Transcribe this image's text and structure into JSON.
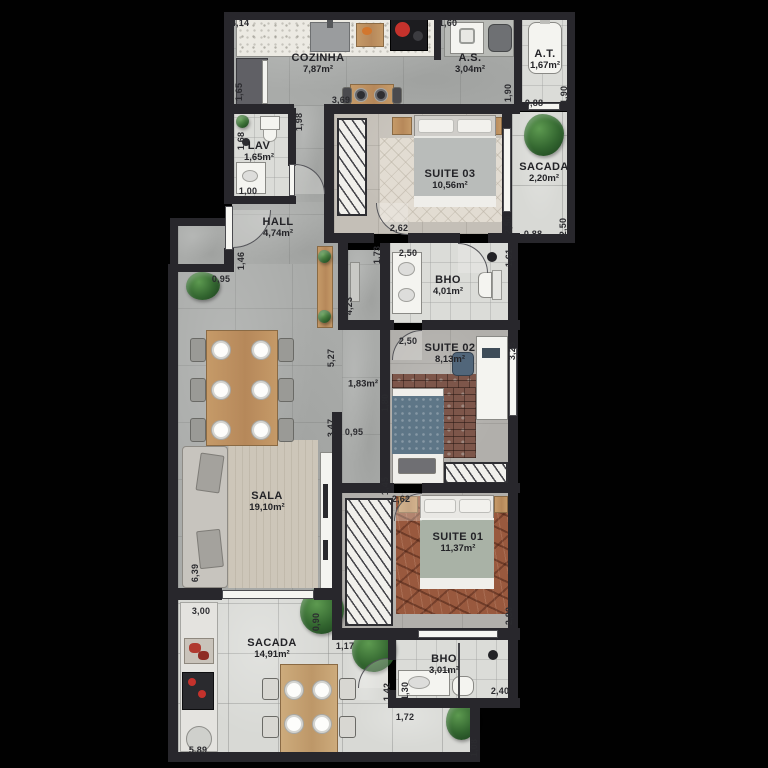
{
  "plan_title": "apartment-floor-plan",
  "colors": {
    "background": "#000000",
    "wall": "#28272c",
    "floor_concrete": "#a9aba9",
    "floor_balcony": "#d8d9d5",
    "wood": "#c59a68",
    "bed_blue": "#5e7687",
    "rug_terracotta": "#99593e",
    "plant_green": "#32652f",
    "label_text": "#232327"
  },
  "rooms": [
    {
      "id": "cozinha",
      "name": "COZINHA",
      "area": "7,87m²",
      "x": 318,
      "y": 64
    },
    {
      "id": "as",
      "name": "A.S.",
      "area": "3,04m²",
      "x": 470,
      "y": 64
    },
    {
      "id": "at",
      "name": "A.T.",
      "area": "1,67m²",
      "x": 545,
      "y": 60
    },
    {
      "id": "lav",
      "name": "LAV",
      "area": "1,65m²",
      "x": 259,
      "y": 152
    },
    {
      "id": "hall",
      "name": "HALL",
      "area": "4,74m²",
      "x": 278,
      "y": 228
    },
    {
      "id": "suite03",
      "name": "SUITE 03",
      "area": "10,56m²",
      "x": 450,
      "y": 180
    },
    {
      "id": "sacada-superior",
      "name": "SACADA",
      "area": "2,20m²",
      "x": 544,
      "y": 173
    },
    {
      "id": "bho-suites",
      "name": "BHO",
      "area": "4,01m²",
      "x": 448,
      "y": 286
    },
    {
      "id": "suite02",
      "name": "SUITE 02",
      "area": "8,13m²",
      "x": 450,
      "y": 354
    },
    {
      "id": "corredor",
      "name": "",
      "area": "1,83m²",
      "x": 363,
      "y": 385
    },
    {
      "id": "sala",
      "name": "SALA",
      "area": "19,10m²",
      "x": 267,
      "y": 502
    },
    {
      "id": "suite01",
      "name": "SUITE 01",
      "area": "11,37m²",
      "x": 458,
      "y": 543
    },
    {
      "id": "sacada-inferior",
      "name": "SACADA",
      "area": "14,91m²",
      "x": 272,
      "y": 649
    },
    {
      "id": "bho-sacada",
      "name": "BHO",
      "area": "3,01m²",
      "x": 444,
      "y": 665
    }
  ],
  "dimensions": [
    {
      "t": "4,14",
      "x": 240,
      "y": 23,
      "v": false
    },
    {
      "t": "1,60",
      "x": 448,
      "y": 23,
      "v": false
    },
    {
      "t": "1,65",
      "x": 239,
      "y": 92,
      "v": true
    },
    {
      "t": "3,69",
      "x": 341,
      "y": 100,
      "v": false
    },
    {
      "t": "1,98",
      "x": 299,
      "y": 122,
      "v": true
    },
    {
      "t": "1,90",
      "x": 508,
      "y": 93,
      "v": true
    },
    {
      "t": "0,88",
      "x": 534,
      "y": 103,
      "v": false
    },
    {
      "t": "1,90",
      "x": 564,
      "y": 95,
      "v": true
    },
    {
      "t": "1,68",
      "x": 241,
      "y": 141,
      "v": true
    },
    {
      "t": "1,00",
      "x": 248,
      "y": 191,
      "v": false
    },
    {
      "t": "2,50",
      "x": 508,
      "y": 225,
      "v": true
    },
    {
      "t": "0,88",
      "x": 533,
      "y": 234,
      "v": false
    },
    {
      "t": "2,50",
      "x": 563,
      "y": 227,
      "v": true
    },
    {
      "t": "2,62",
      "x": 399,
      "y": 228,
      "v": false
    },
    {
      "t": "2,50",
      "x": 408,
      "y": 253,
      "v": false
    },
    {
      "t": "1,73",
      "x": 377,
      "y": 255,
      "v": true
    },
    {
      "t": "1,61",
      "x": 509,
      "y": 258,
      "v": true
    },
    {
      "t": "1,46",
      "x": 241,
      "y": 261,
      "v": true
    },
    {
      "t": "0,95",
      "x": 221,
      "y": 279,
      "v": false
    },
    {
      "t": "4,23",
      "x": 349,
      "y": 306,
      "v": true
    },
    {
      "t": "5,27",
      "x": 331,
      "y": 358,
      "v": true
    },
    {
      "t": "2,50",
      "x": 408,
      "y": 341,
      "v": false
    },
    {
      "t": "3,25",
      "x": 512,
      "y": 351,
      "v": true
    },
    {
      "t": "1,80",
      "x": 385,
      "y": 403,
      "v": true
    },
    {
      "t": "0,95",
      "x": 354,
      "y": 432,
      "v": false
    },
    {
      "t": "3,47",
      "x": 331,
      "y": 428,
      "v": true
    },
    {
      "t": "1,45",
      "x": 385,
      "y": 486,
      "v": true
    },
    {
      "t": "2,62",
      "x": 401,
      "y": 499,
      "v": false
    },
    {
      "t": "2,80",
      "x": 509,
      "y": 616,
      "v": true
    },
    {
      "t": "6,39",
      "x": 195,
      "y": 573,
      "v": true
    },
    {
      "t": "3,00",
      "x": 201,
      "y": 611,
      "v": false
    },
    {
      "t": "0,90",
      "x": 316,
      "y": 622,
      "v": true
    },
    {
      "t": "1,17",
      "x": 345,
      "y": 646,
      "v": false
    },
    {
      "t": "1,42",
      "x": 387,
      "y": 692,
      "v": true
    },
    {
      "t": "1,30",
      "x": 405,
      "y": 691,
      "v": true
    },
    {
      "t": "1,72",
      "x": 405,
      "y": 717,
      "v": false
    },
    {
      "t": "2,40",
      "x": 500,
      "y": 691,
      "v": false
    },
    {
      "t": "1,08",
      "x": 474,
      "y": 748,
      "v": true
    },
    {
      "t": "5,89",
      "x": 198,
      "y": 750,
      "v": false
    }
  ]
}
